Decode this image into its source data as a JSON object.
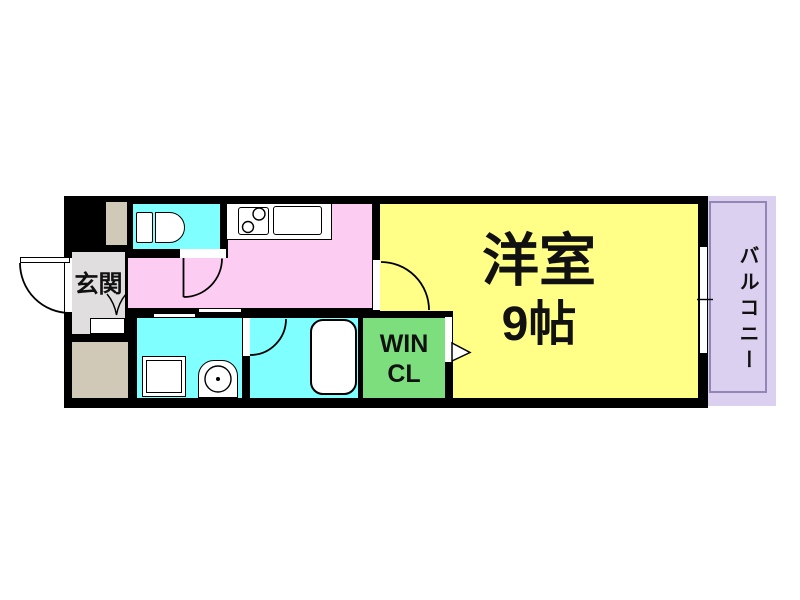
{
  "labels": {
    "entrance": "玄関",
    "closet_line1": "WIN",
    "closet_line2": "CL",
    "main_room_name": "洋室",
    "main_room_size": "9帖",
    "balcony": "バルコニー"
  },
  "colors": {
    "wall": "#000000",
    "main_room": "#FFFF87",
    "kitchen": "#FCCCF2",
    "wet_area": "#7FFFFF",
    "closet": "#7CDE7C",
    "balcony": "#DCD0F0",
    "shaft": "#D1C9B8",
    "entrance_floor": "#E0DEDE",
    "fixture": "#FFFFFF",
    "balcony_outline": "#9286B4"
  }
}
